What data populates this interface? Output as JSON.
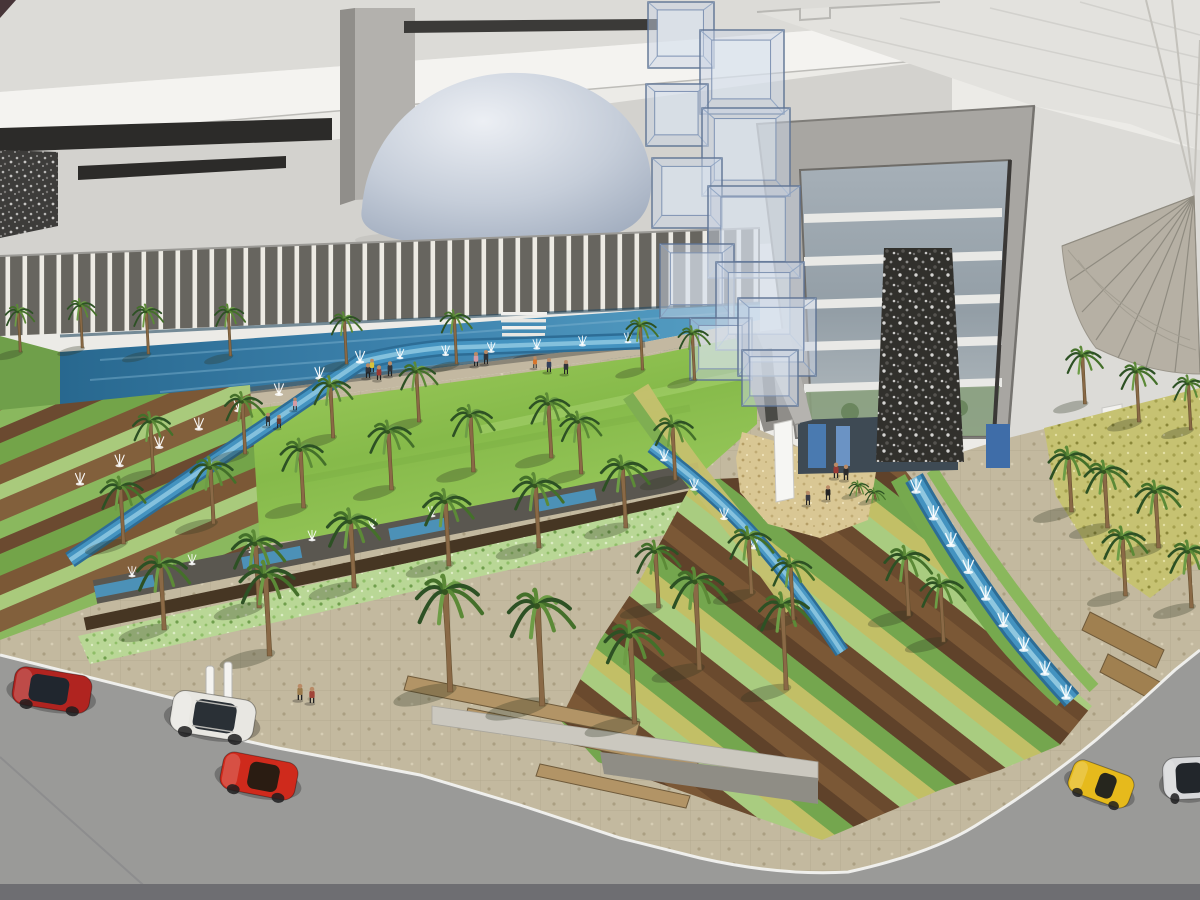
{
  "scene": {
    "type": "architectural-3d-rendering",
    "description": "Bird's-eye rendering of a cultural complex: louvered facade building with reflecting pool, dome, glass-cube cascade, glass tower with gabion stone column, tensile canopy, palm-lined gardens with fountain channels, striped planting beds, perimeter roads with cars"
  },
  "palette": {
    "roof_light": "#dcdbd7",
    "fascia_white": "#f4f3f0",
    "window_band_dark": "#2c2b29",
    "facade_stripe_dark": "#67655f",
    "facade_stripe_white": "#edebe4",
    "pool_blue": "#3f85b0",
    "channel_blue": "#4493c0",
    "lawn_green": "#86ba4a",
    "sand_tan": "#d9c794",
    "paving_beige": "#c3b99f",
    "road_gray": "#9a9a98",
    "stone_dark": "#31302c",
    "glass_blue": "#c9d3e3",
    "canopy_tan": "#b6b0a4"
  },
  "architecture": {
    "left_building": {
      "features": [
        "sloped roof planes",
        "white fascia band",
        "dark window bands",
        "gabion stone wall",
        "vertical louver stripe facade",
        "reflecting pool with stairs"
      ]
    },
    "dome": {
      "shape": "flattened ellipsoid",
      "finish": "blue-gray gradient"
    },
    "glass_cube_cascade": {
      "count": 11
    },
    "right_tower": {
      "glass_bands": 5,
      "stone_column": true,
      "entry_pillars": 2
    },
    "tensile_canopy": {
      "ribs": 8
    }
  },
  "cubes": [
    [
      648,
      2,
      66
    ],
    [
      700,
      30,
      84
    ],
    [
      646,
      84,
      62
    ],
    [
      702,
      108,
      88
    ],
    [
      652,
      158,
      70
    ],
    [
      708,
      186,
      92
    ],
    [
      660,
      244,
      74
    ],
    [
      716,
      262,
      88
    ],
    [
      690,
      318,
      62
    ],
    [
      738,
      298,
      78
    ],
    [
      742,
      350,
      56
    ]
  ],
  "palms": [
    [
      18,
      312,
      0.55,
      40
    ],
    [
      80,
      306,
      0.55,
      42
    ],
    [
      146,
      312,
      0.58,
      42
    ],
    [
      228,
      312,
      0.58,
      44
    ],
    [
      344,
      320,
      0.6,
      44
    ],
    [
      454,
      318,
      0.6,
      46
    ],
    [
      640,
      326,
      0.6,
      44
    ],
    [
      692,
      334,
      0.6,
      46
    ],
    [
      1082,
      356,
      0.7,
      48
    ],
    [
      1136,
      372,
      0.7,
      50
    ],
    [
      1188,
      384,
      0.65,
      46
    ],
    [
      150,
      422,
      0.75,
      52
    ],
    [
      242,
      402,
      0.75,
      52
    ],
    [
      330,
      386,
      0.75,
      52
    ],
    [
      416,
      372,
      0.72,
      50
    ],
    [
      120,
      488,
      0.85,
      56
    ],
    [
      210,
      468,
      0.85,
      56
    ],
    [
      300,
      450,
      0.85,
      58
    ],
    [
      388,
      432,
      0.85,
      58
    ],
    [
      470,
      416,
      0.82,
      56
    ],
    [
      548,
      404,
      0.8,
      54
    ],
    [
      578,
      422,
      0.78,
      52
    ],
    [
      672,
      426,
      0.78,
      54
    ],
    [
      160,
      566,
      1.0,
      64
    ],
    [
      255,
      544,
      1.0,
      64
    ],
    [
      350,
      522,
      1.0,
      66
    ],
    [
      445,
      502,
      0.95,
      64
    ],
    [
      535,
      486,
      0.95,
      62
    ],
    [
      622,
      468,
      0.92,
      60
    ],
    [
      265,
      576,
      1.1,
      80
    ],
    [
      445,
      592,
      1.25,
      100
    ],
    [
      537,
      606,
      1.25,
      100
    ],
    [
      630,
      636,
      1.1,
      88
    ],
    [
      695,
      582,
      1.05,
      88
    ],
    [
      782,
      606,
      1.0,
      84
    ],
    [
      655,
      552,
      0.85,
      56
    ],
    [
      748,
      538,
      0.85,
      56
    ],
    [
      790,
      566,
      0.8,
      54
    ],
    [
      905,
      558,
      0.9,
      58
    ],
    [
      940,
      586,
      0.85,
      56
    ],
    [
      1068,
      458,
      0.85,
      54
    ],
    [
      1104,
      472,
      0.85,
      56
    ],
    [
      1155,
      492,
      0.85,
      56
    ],
    [
      1122,
      538,
      0.85,
      58
    ],
    [
      1188,
      552,
      0.85,
      56
    ],
    [
      858,
      486,
      0.4,
      7
    ],
    [
      874,
      493,
      0.38,
      6
    ]
  ],
  "vehicles": [
    {
      "name": "car-red-hatchback",
      "body": "#b02420",
      "glass": "#20262e",
      "x": 52,
      "y": 690,
      "w": 78,
      "h": 38,
      "angle": 9,
      "cab": [
        -0.04,
        0.5
      ]
    },
    {
      "name": "car-white-suv",
      "body": "#e8e7e2",
      "glass": "#2a3036",
      "x": 213,
      "y": 716,
      "w": 84,
      "h": 42,
      "angle": 9,
      "cab": [
        0.02,
        0.5
      ],
      "rails": true
    },
    {
      "name": "car-red-coupe",
      "body": "#cf2a1c",
      "glass": "#2a1c12",
      "x": 259,
      "y": 776,
      "w": 76,
      "h": 38,
      "angle": 11,
      "cab": [
        0.06,
        0.4
      ]
    },
    {
      "name": "car-yellow-roadster",
      "body": "#e6ba1c",
      "glass": "#26261e",
      "x": 1101,
      "y": 784,
      "w": 64,
      "h": 34,
      "angle": 20,
      "cab": [
        0.08,
        0.28
      ]
    },
    {
      "name": "car-silver-sedan",
      "body": "#d7d8da",
      "glass": "#22262b",
      "x": 1190,
      "y": 778,
      "w": 54,
      "h": 42,
      "angle": -3,
      "cab": [
        0.0,
        0.52
      ]
    }
  ],
  "people": [
    [
      368,
      378,
      "#30343a",
      1
    ],
    [
      379,
      380,
      "#9a3a34",
      1
    ],
    [
      390,
      376,
      "#30343a",
      1
    ],
    [
      372,
      372,
      "#d8c23a",
      0.9
    ],
    [
      476,
      366,
      "#d49aa4",
      0.95
    ],
    [
      486,
      364,
      "#30343a",
      0.95
    ],
    [
      535,
      368,
      "#d8742a",
      0.8
    ],
    [
      549,
      372,
      "#32405c",
      0.95
    ],
    [
      566,
      374,
      "#30343a",
      0.95
    ],
    [
      268,
      426,
      "#30343a",
      0.9
    ],
    [
      279,
      428,
      "#6a3a30",
      0.9
    ],
    [
      295,
      410,
      "#d49aa4",
      0.85
    ],
    [
      836,
      478,
      "#9a3a34",
      1.05
    ],
    [
      846,
      480,
      "#2c2c2c",
      1.05
    ],
    [
      828,
      500,
      "#242424",
      1
    ],
    [
      808,
      505,
      "#3c3c44",
      0.95
    ],
    [
      300,
      700,
      "#9a7a4a",
      1.1
    ],
    [
      312,
      703,
      "#a04438",
      1.1
    ]
  ],
  "bollards": [
    [
      206,
      666
    ],
    [
      224,
      662
    ]
  ],
  "fountain_lines": [
    {
      "name": "garden-channel",
      "pts": [
        [
          80,
          484
        ],
        [
          240,
          410
        ],
        [
          360,
          362
        ]
      ],
      "count": 8,
      "s": 0.7
    },
    {
      "name": "pool-walkway",
      "pts": [
        [
          400,
          358
        ],
        [
          628,
          342
        ]
      ],
      "count": 6,
      "s": 0.58
    },
    {
      "name": "cross-band",
      "pts": [
        [
          132,
          576
        ],
        [
          432,
          516
        ]
      ],
      "count": 6,
      "s": 0.6
    },
    {
      "name": "entry-left-channel",
      "pts": [
        [
          664,
          460
        ],
        [
          754,
          548
        ]
      ],
      "count": 4,
      "s": 0.65
    },
    {
      "name": "entry-right-channel",
      "pts": [
        [
          916,
          492
        ],
        [
          1006,
          630
        ],
        [
          1066,
          698
        ]
      ],
      "count": 9,
      "s": 0.8
    }
  ]
}
